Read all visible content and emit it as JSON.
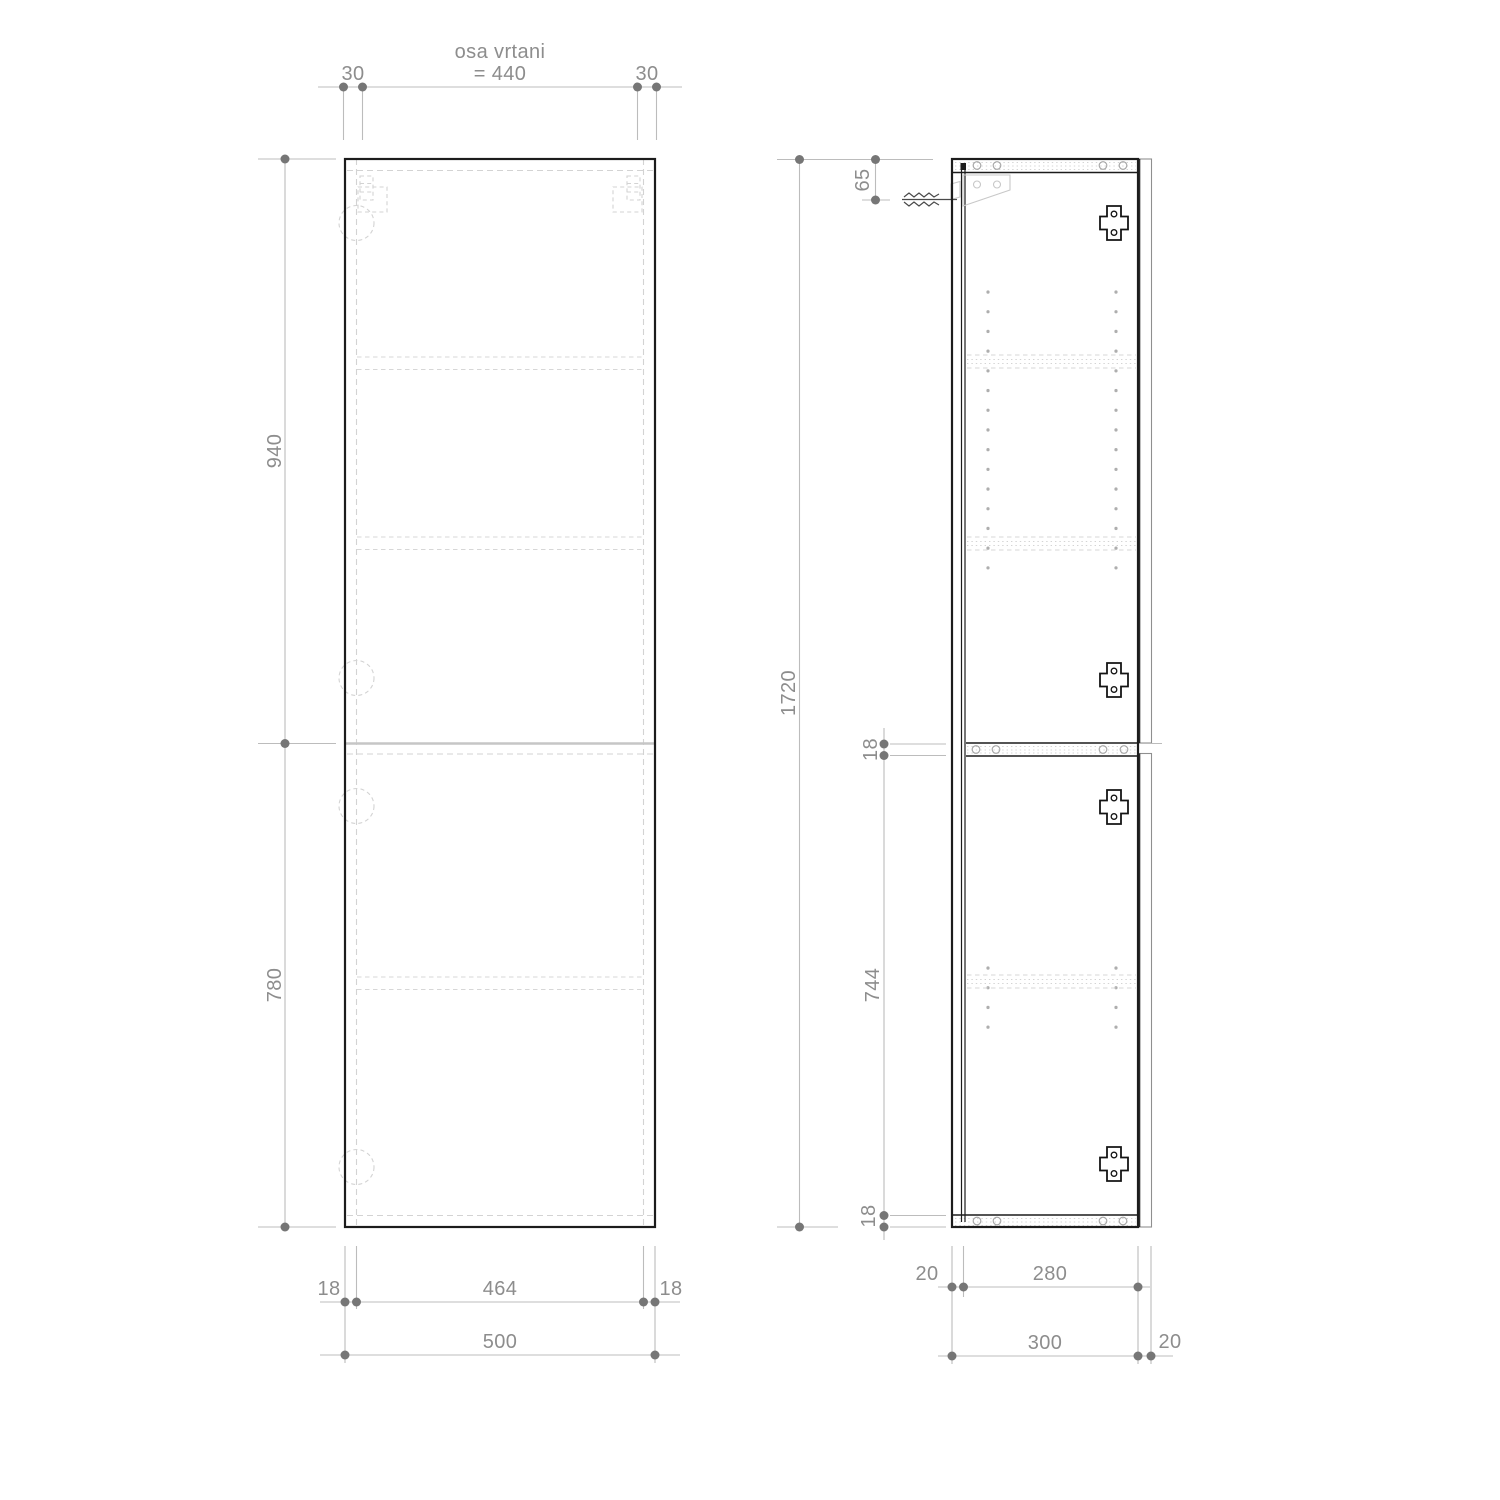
{
  "drawing": {
    "front": {
      "axis_title": "osa vrtani",
      "axis_value": "= 440",
      "offset_left": "30",
      "offset_right": "30",
      "upper_door_height": "940",
      "lower_door_height": "780",
      "inset_left": "18",
      "inner_width": "464",
      "inset_right": "18",
      "total_width": "500"
    },
    "side": {
      "hanger_offset": "65",
      "total_height": "1720",
      "divider_thickness": "18",
      "lower_inner_height": "744",
      "bottom_thickness": "18",
      "back_offset": "20",
      "inner_depth": "280",
      "body_depth": "300",
      "door_thickness": "20"
    },
    "colors": {
      "outline": "#1c1c1c",
      "dimension_line": "#bcbcbc",
      "dimension_dot": "#767676",
      "label_text": "#8d8d8d",
      "hidden_line": "#d3d3d3",
      "background": "#ffffff"
    }
  }
}
